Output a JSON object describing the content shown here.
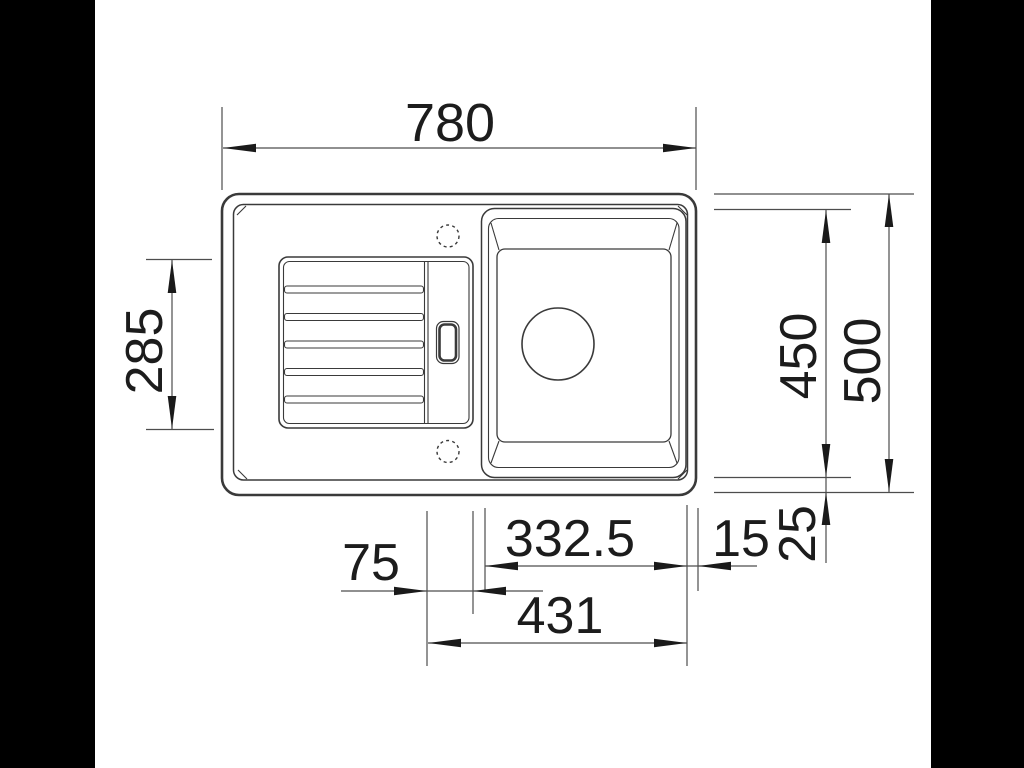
{
  "drawing": {
    "subject": "Kitchen sink with drainboard — dimensioned top view technical drawing",
    "view": "top",
    "dimension_labels": {
      "total_width": "780",
      "drainboard_depth": "285",
      "bowl_depth": "450",
      "total_depth": "500",
      "bowl_width": "332.5",
      "edge_gap": "15",
      "bottom_gap": "25",
      "channel_width": "75",
      "bowl_offset_right": "431"
    },
    "colors": {
      "background": "#ffffff",
      "letterbox": "#000000",
      "drawing_line": "#3a3a3a",
      "dimension_line": "#4d4d4d",
      "dimension_text": "#1c1c1c"
    }
  }
}
